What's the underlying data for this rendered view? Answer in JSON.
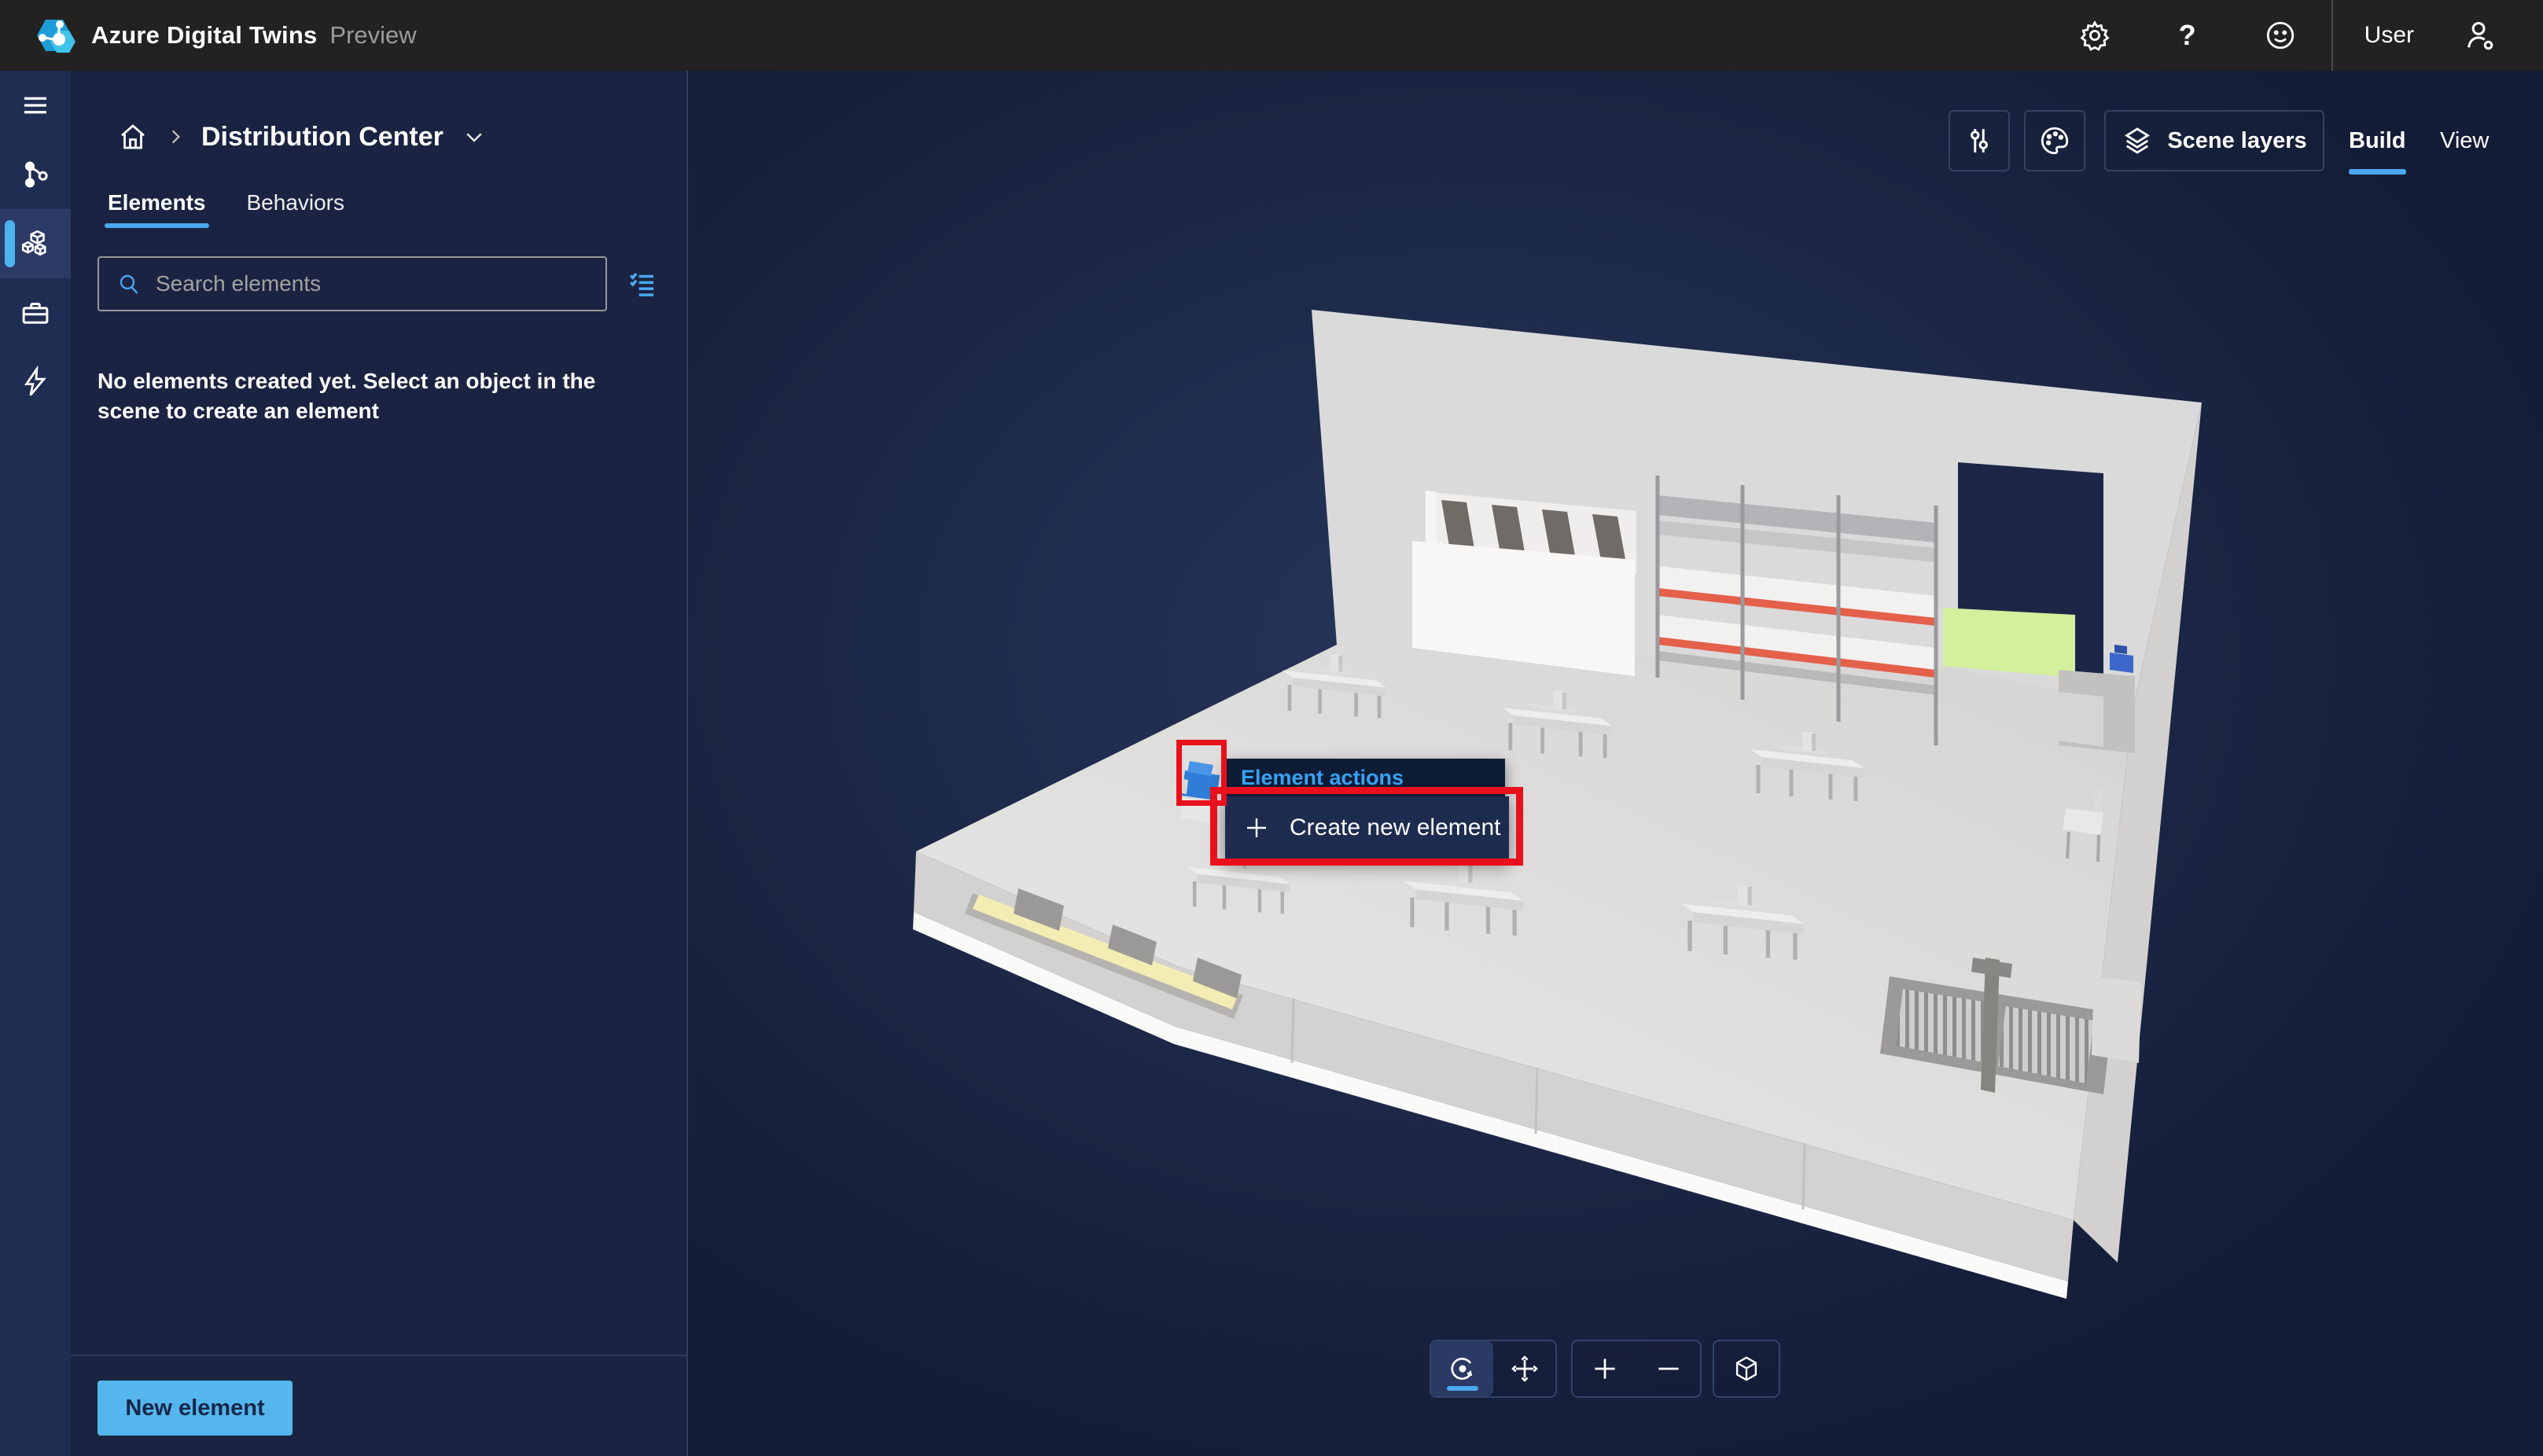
{
  "app": {
    "title": "Azure Digital Twins",
    "badge": "Preview",
    "help_label": "?",
    "user_label": "User"
  },
  "topbar": {
    "icons": [
      "settings-gear",
      "help",
      "feedback-smiley",
      "user-settings"
    ]
  },
  "sidebar": {
    "items": [
      {
        "icon": "menu",
        "active": false
      },
      {
        "icon": "twin-graph",
        "active": false
      },
      {
        "icon": "scenes-cubes",
        "active": true
      },
      {
        "icon": "toolbox",
        "active": false
      },
      {
        "icon": "events-lightning",
        "active": false
      }
    ]
  },
  "panel": {
    "breadcrumb": {
      "scene_name": "Distribution Center"
    },
    "tabs": [
      {
        "label": "Elements",
        "active": true
      },
      {
        "label": "Behaviors",
        "active": false
      }
    ],
    "search": {
      "placeholder": "Search elements"
    },
    "empty_state": "No elements created yet. Select an object in the scene to create an element",
    "new_element_button": "New element"
  },
  "viewport": {
    "scene_layers_button": "Scene layers",
    "mode_tabs": [
      {
        "label": "Build",
        "active": true
      },
      {
        "label": "View",
        "active": false
      }
    ],
    "camera_toolbar": [
      {
        "icon": "orbit",
        "active": true
      },
      {
        "icon": "pan",
        "active": false
      },
      {
        "icon": "zoom-in",
        "active": false
      },
      {
        "icon": "zoom-out",
        "active": false
      },
      {
        "icon": "reset-view",
        "active": false
      }
    ]
  },
  "context_menu": {
    "title": "Element actions",
    "items": [
      {
        "icon": "plus",
        "label": "Create new element"
      }
    ]
  },
  "annotations": {
    "color": "#e8101c",
    "boxes": [
      "selected-scene-object",
      "create-new-element-menu-item"
    ]
  },
  "colors": {
    "accent_blue": "#4ca9ef",
    "link_blue": "#39a1f2",
    "button_blue": "#54b6ec",
    "annotation_red": "#e8101c",
    "floor_gray": "#dcdbd9",
    "doorway_navy": "#1c2747",
    "green_zone": "#d3f09c",
    "shelf_stripe_orange": "#e4604b",
    "skylight_yellow": "#f3edb4",
    "selected_object_blue": "#2f7dd8"
  }
}
